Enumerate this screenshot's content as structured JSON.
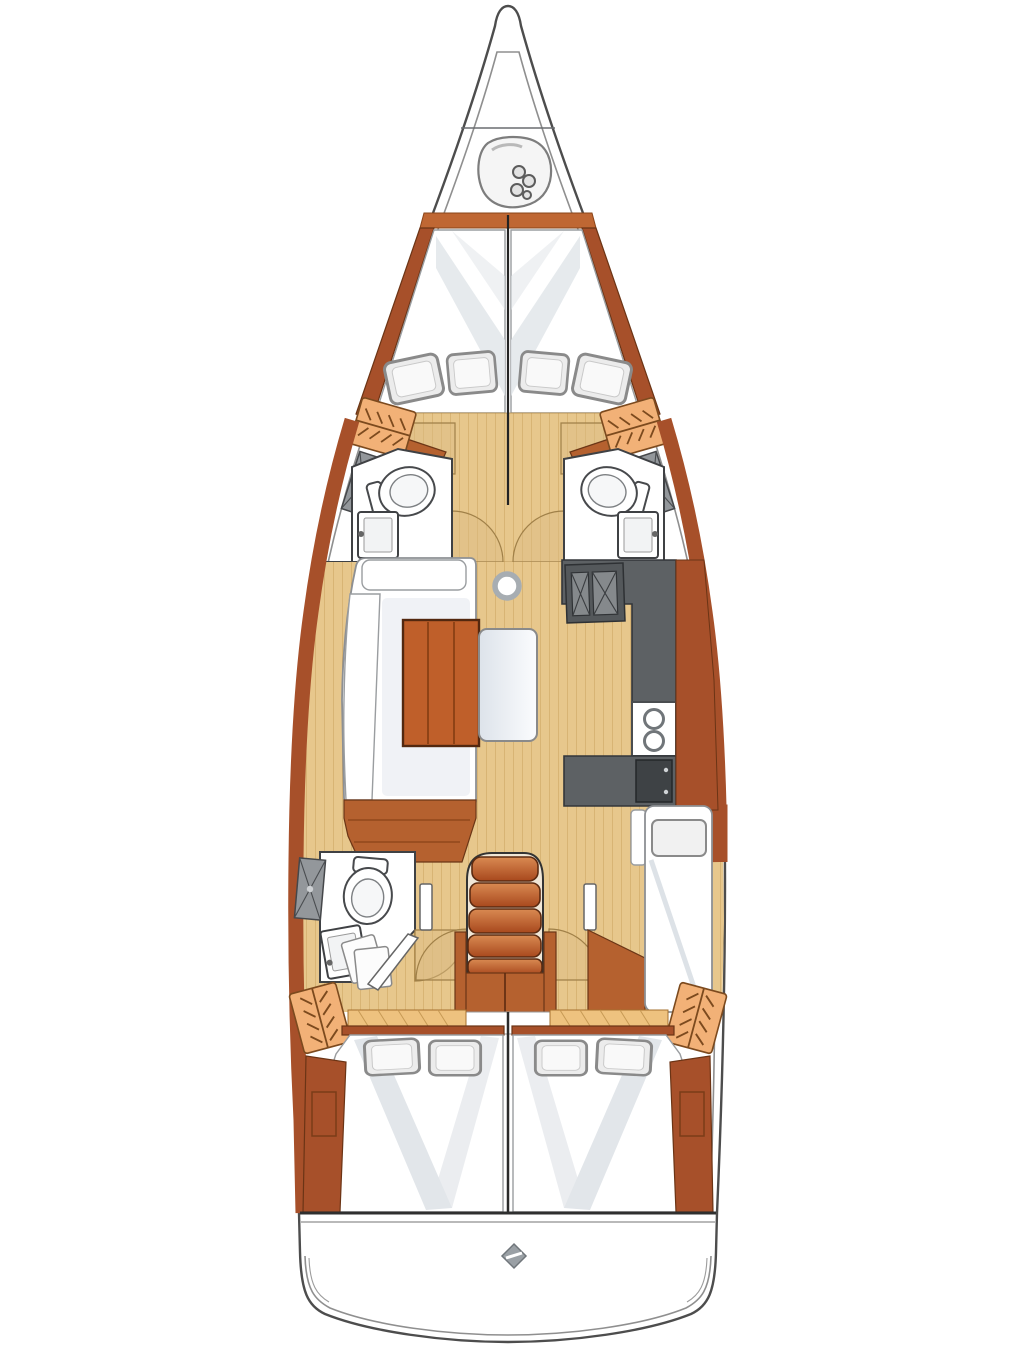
{
  "figure": {
    "kind": "sailboat-interior-floor-plan",
    "orientation": "bow-up",
    "visible_text": []
  },
  "palette": {
    "outline": "#4d4d4d",
    "innerLine": "#8f8f8f",
    "floor": "#e7c78c",
    "floorLine": "#cda45f",
    "woodDark": "#a7502a",
    "woodMid": "#b5612f",
    "trim": "#bf6733",
    "shelf": "#eec27f",
    "locker": "#f2b177",
    "lockerLine": "#7c4a1e",
    "counter": "#5d6164",
    "counterDark": "#3e4245",
    "hatch": "#93979b",
    "cushionShade": "#e2e6ea",
    "pillow": "#ececec",
    "step": "#c2602c",
    "stepEdge": "#5c2a10"
  },
  "icons": [
    {
      "name": "windlass-icon",
      "meaning": "anchor windlass / chain locker in bow"
    },
    {
      "name": "hanger-locker-icon",
      "meaning": "hanging wardrobe locker"
    },
    {
      "name": "hatch-panel-icon",
      "meaning": "hatched grey hull panel"
    },
    {
      "name": "toilet-icon",
      "meaning": "marine toilet"
    },
    {
      "name": "sink-icon",
      "meaning": "washbasin"
    },
    {
      "name": "double-sink-icon",
      "meaning": "galley twin sink"
    },
    {
      "name": "burner-icon",
      "meaning": "stove burners"
    },
    {
      "name": "mast-icon",
      "meaning": "mast/compression post"
    },
    {
      "name": "steering-icon",
      "meaning": "transom fitting"
    }
  ],
  "regions": [
    "bow-anchor-locker",
    "forward-cabin-port",
    "forward-cabin-starboard",
    "forward-head-port",
    "forward-head-starboard",
    "saloon-settee-port",
    "saloon-table",
    "galley-starboard",
    "aft-head-port",
    "companionway-stairs",
    "berth-starboard",
    "aft-cabin-port",
    "aft-cabin-starboard",
    "transom"
  ]
}
